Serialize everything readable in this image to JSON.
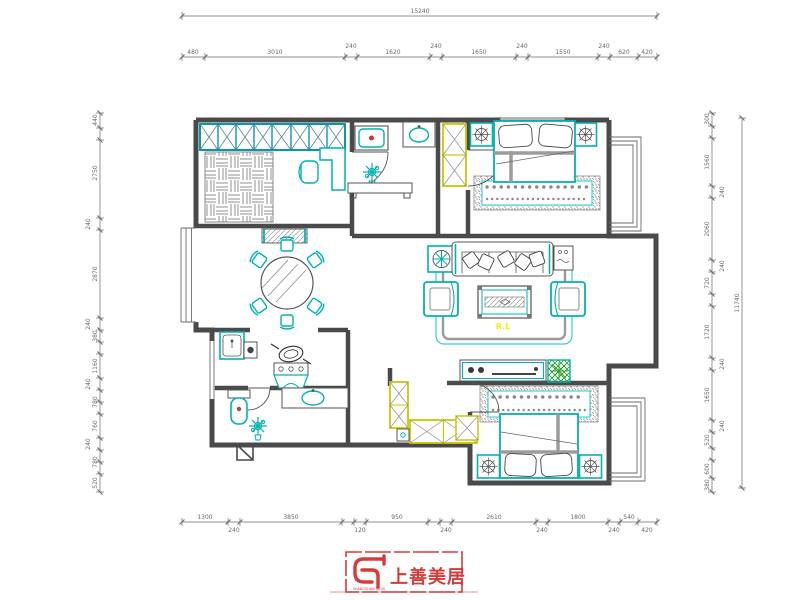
{
  "plan": {
    "living_room_label": "R.L"
  },
  "logo": {
    "brand": "上善美居",
    "micro": "SHANGSHAN MEIJU"
  },
  "colors": {
    "wall": "#4a4a4a",
    "furniture_teal": "#00b2b2",
    "wardrobe_yellow": "#c9c900",
    "accent_red": "#c23a3a",
    "plant_green": "#2f9e2f",
    "label_yellow": "#f0f000",
    "logo_red": "#d63b3b",
    "dim": "#6a6a6a"
  },
  "dimensions": {
    "top_total": {
      "axis": "h",
      "y": 16,
      "x1": 182,
      "x2": 657,
      "ticks": [
        182,
        657
      ],
      "labels": [
        {
          "t": "15240",
          "p": 420
        }
      ]
    },
    "top_chain": {
      "axis": "h",
      "y": 57,
      "x1": 182,
      "x2": 657,
      "ticks": [
        182,
        205,
        345,
        357,
        430,
        442,
        516,
        528,
        598,
        610,
        638,
        657
      ],
      "labels": [
        {
          "t": "480",
          "p": 193
        },
        {
          "t": "3010",
          "p": 275
        },
        {
          "t": "240",
          "p": 351,
          "o": -9
        },
        {
          "t": "1620",
          "p": 393
        },
        {
          "t": "240",
          "p": 436,
          "o": -9
        },
        {
          "t": "1650",
          "p": 479
        },
        {
          "t": "240",
          "p": 522,
          "o": -9
        },
        {
          "t": "1550",
          "p": 563
        },
        {
          "t": "240",
          "p": 604,
          "o": -9
        },
        {
          "t": "620",
          "p": 624
        },
        {
          "t": "420",
          "p": 647
        }
      ]
    },
    "bottom_chain": {
      "axis": "h",
      "y": 522,
      "x1": 182,
      "x2": 657,
      "ticks": [
        182,
        228,
        240,
        342,
        354,
        366,
        428,
        440,
        452,
        536,
        548,
        608,
        620,
        638,
        657
      ],
      "labels": [
        {
          "t": "1300",
          "p": 205
        },
        {
          "t": "240",
          "p": 234,
          "o": 10
        },
        {
          "t": "3850",
          "p": 291
        },
        {
          "t": "120",
          "p": 360,
          "o": 10
        },
        {
          "t": "950",
          "p": 397
        },
        {
          "t": "240",
          "p": 446,
          "o": 10
        },
        {
          "t": "2610",
          "p": 494
        },
        {
          "t": "240",
          "p": 542,
          "o": 10
        },
        {
          "t": "1800",
          "p": 578
        },
        {
          "t": "240",
          "p": 614,
          "o": 10
        },
        {
          "t": "540",
          "p": 629
        },
        {
          "t": "420",
          "p": 647,
          "o": 10
        }
      ]
    },
    "left_chain": {
      "axis": "v",
      "x": 100,
      "y1": 113,
      "y2": 492,
      "ticks": [
        113,
        128,
        140,
        218,
        230,
        318,
        330,
        342,
        354,
        378,
        390,
        402,
        414,
        438,
        450,
        462,
        474,
        492
      ],
      "labels": [
        {
          "t": "440",
          "p": 120
        },
        {
          "t": "2750",
          "p": 173
        },
        {
          "t": "240",
          "p": 224,
          "o": -10
        },
        {
          "t": "2870",
          "p": 274
        },
        {
          "t": "240",
          "p": 324,
          "o": -10
        },
        {
          "t": "380",
          "p": 336
        },
        {
          "t": "1160",
          "p": 366
        },
        {
          "t": "240",
          "p": 384,
          "o": -10
        },
        {
          "t": "780",
          "p": 402
        },
        {
          "t": "760",
          "p": 426
        },
        {
          "t": "240",
          "p": 444,
          "o": -10
        },
        {
          "t": "780",
          "p": 462
        },
        {
          "t": "520",
          "p": 483
        }
      ]
    },
    "right_chain": {
      "axis": "v",
      "x": 712,
      "y1": 113,
      "y2": 492,
      "ticks": [
        113,
        126,
        138,
        186,
        198,
        260,
        272,
        294,
        306,
        358,
        370,
        420,
        432,
        448,
        460,
        478,
        492
      ],
      "labels": [
        {
          "t": "300",
          "p": 119
        },
        {
          "t": "1560",
          "p": 162
        },
        {
          "t": "240",
          "p": 192,
          "o": 12
        },
        {
          "t": "2060",
          "p": 229
        },
        {
          "t": "240",
          "p": 266,
          "o": 12
        },
        {
          "t": "720",
          "p": 283
        },
        {
          "t": "1720",
          "p": 332
        },
        {
          "t": "240",
          "p": 364,
          "o": 12
        },
        {
          "t": "1650",
          "p": 395
        },
        {
          "t": "240",
          "p": 426,
          "o": 12
        },
        {
          "t": "520",
          "p": 440
        },
        {
          "t": "600",
          "p": 469
        },
        {
          "t": "380",
          "p": 485
        }
      ]
    },
    "right_total": {
      "axis": "v",
      "x": 742,
      "y1": 118,
      "y2": 488,
      "ticks": [
        118,
        488
      ],
      "labels": [
        {
          "t": "11740",
          "p": 303
        }
      ]
    }
  }
}
